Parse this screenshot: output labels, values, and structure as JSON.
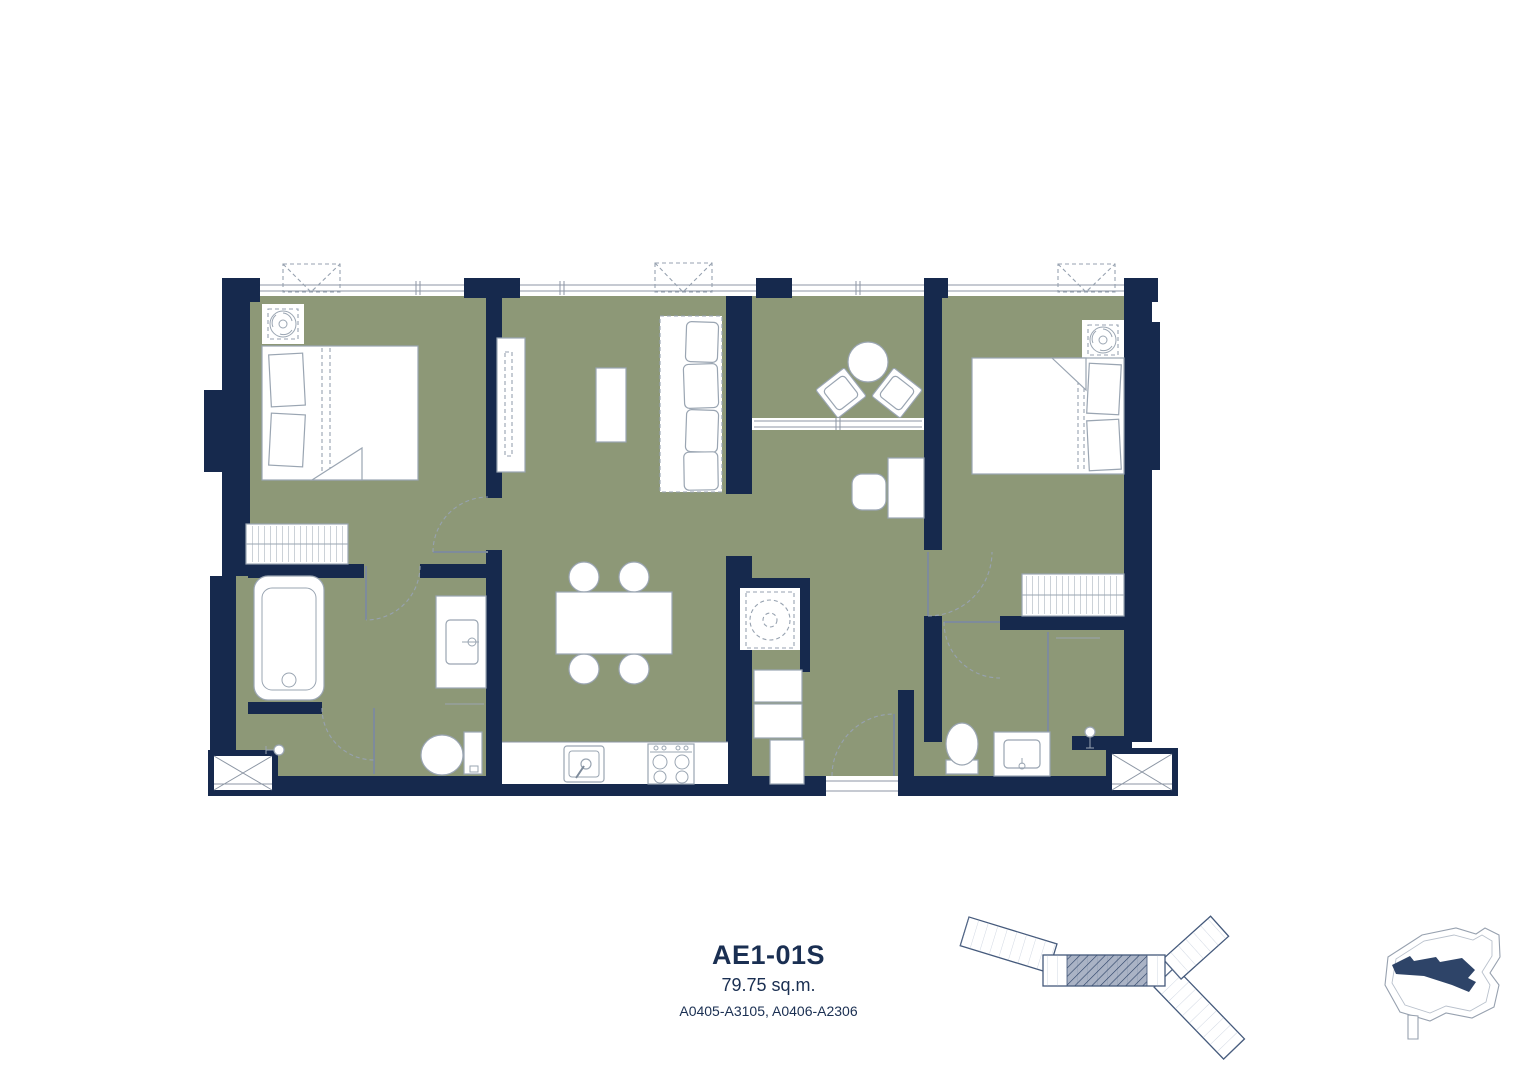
{
  "caption": {
    "unit_name": "AE1-01S",
    "unit_area": "79.75 sq.m.",
    "unit_numbers": "A0405-A3105, A0406-A2306"
  },
  "colors": {
    "wall_navy": "#16294D",
    "floor_green": "#8D9877",
    "fixture_line_gray": "#9AA5B2",
    "window_line_gray": "#8C96A4",
    "caption_text_navy": "#1A2F52",
    "key_plan_outline": "#44597B",
    "site_building_navy": "#2E4468"
  },
  "icons": [
    "air-conditioner-icon",
    "washing-machine-icon",
    "double-bed",
    "wardrobe",
    "sofa",
    "tv-console",
    "coffee-table",
    "dining-table-4-chairs",
    "balcony-table-2-chairs",
    "desk-and-chair",
    "bathtub",
    "shower-head",
    "toilet",
    "vanity-basin",
    "kitchen-sink",
    "stove-4-burner",
    "entry-door-swing",
    "ac-awning-marker",
    "ac-ledge-cross-box",
    "building-key-plan",
    "site-location-map"
  ]
}
